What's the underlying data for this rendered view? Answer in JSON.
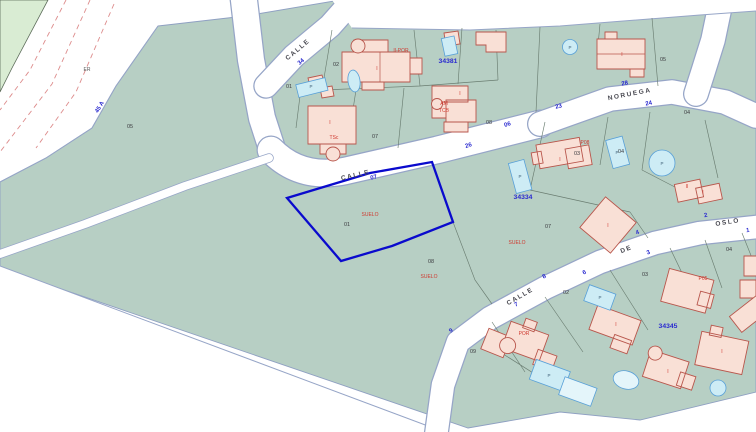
{
  "annotations": {
    "er_label": "ER",
    "km_label": "45 A"
  },
  "streets": [
    {
      "label": "CALLE"
    },
    {
      "label": "34"
    },
    {
      "label": "CALLE"
    },
    {
      "label": "07"
    },
    {
      "label": "06"
    },
    {
      "label": "26"
    },
    {
      "label": "NORUEGA"
    },
    {
      "label": "28"
    },
    {
      "label": "24"
    },
    {
      "label": "23"
    },
    {
      "label": "CALLE"
    },
    {
      "label": "DE"
    },
    {
      "label": "OSLO"
    },
    {
      "label": "9"
    },
    {
      "label": "7"
    },
    {
      "label": "8"
    },
    {
      "label": "6"
    },
    {
      "label": "4"
    },
    {
      "label": "3"
    },
    {
      "label": "2"
    },
    {
      "label": "1"
    }
  ],
  "blocks": [
    "34381",
    "34334",
    "34345"
  ],
  "parcels": [
    "05",
    "01",
    "02",
    "07",
    "08",
    "05",
    "04",
    "03",
    "04",
    "07",
    "08",
    "09",
    "02",
    "03",
    "04"
  ],
  "selected_parcel": {
    "number": "01",
    "land_use_label": "SUELO"
  },
  "construction_labels": [
    "II-POR",
    "AM",
    "TCB",
    "TSc",
    "SUELO",
    "SUELO",
    "P08",
    "P05",
    "POR",
    "II",
    "I"
  ],
  "marks": {
    "floor": "I",
    "pool": "P"
  },
  "colors": {
    "selected_parcel_outline": "#0a0acd",
    "parcel_fill": "#b7cfc4",
    "green_area_fill": "#d9ecd3",
    "building_fill": "#f9e0d6",
    "building_stroke": "#b8564c",
    "pool_fill": "#cdecf5",
    "pool_stroke": "#58a0d8",
    "street_number_text": "#2a2ad0",
    "construction_text": "#cf3a30"
  }
}
